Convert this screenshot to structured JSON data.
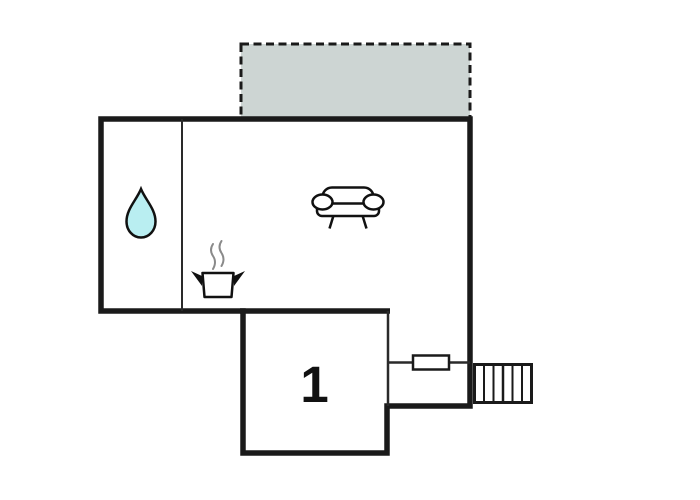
{
  "plan": {
    "kind": "floor-plan",
    "rooms": {
      "bedroom": {
        "label": "1"
      }
    },
    "stairs": {
      "treads": 6
    },
    "icons": [
      "terrace-area",
      "water-drop-icon",
      "cooking-pot-icon",
      "steam-icon",
      "sofa-icon",
      "door-window-icon",
      "stairs-icon"
    ]
  },
  "colors": {
    "background": "#ffffff",
    "wall": "#1a1a1a",
    "thin_wall": "#2a2a2a",
    "terrace_fill": "#cdd5d3",
    "terrace_dash": "#1a1a1a",
    "water_drop_fill": "#b9eef1",
    "steam": "#8a8a8a",
    "icon_stroke": "#111111"
  }
}
